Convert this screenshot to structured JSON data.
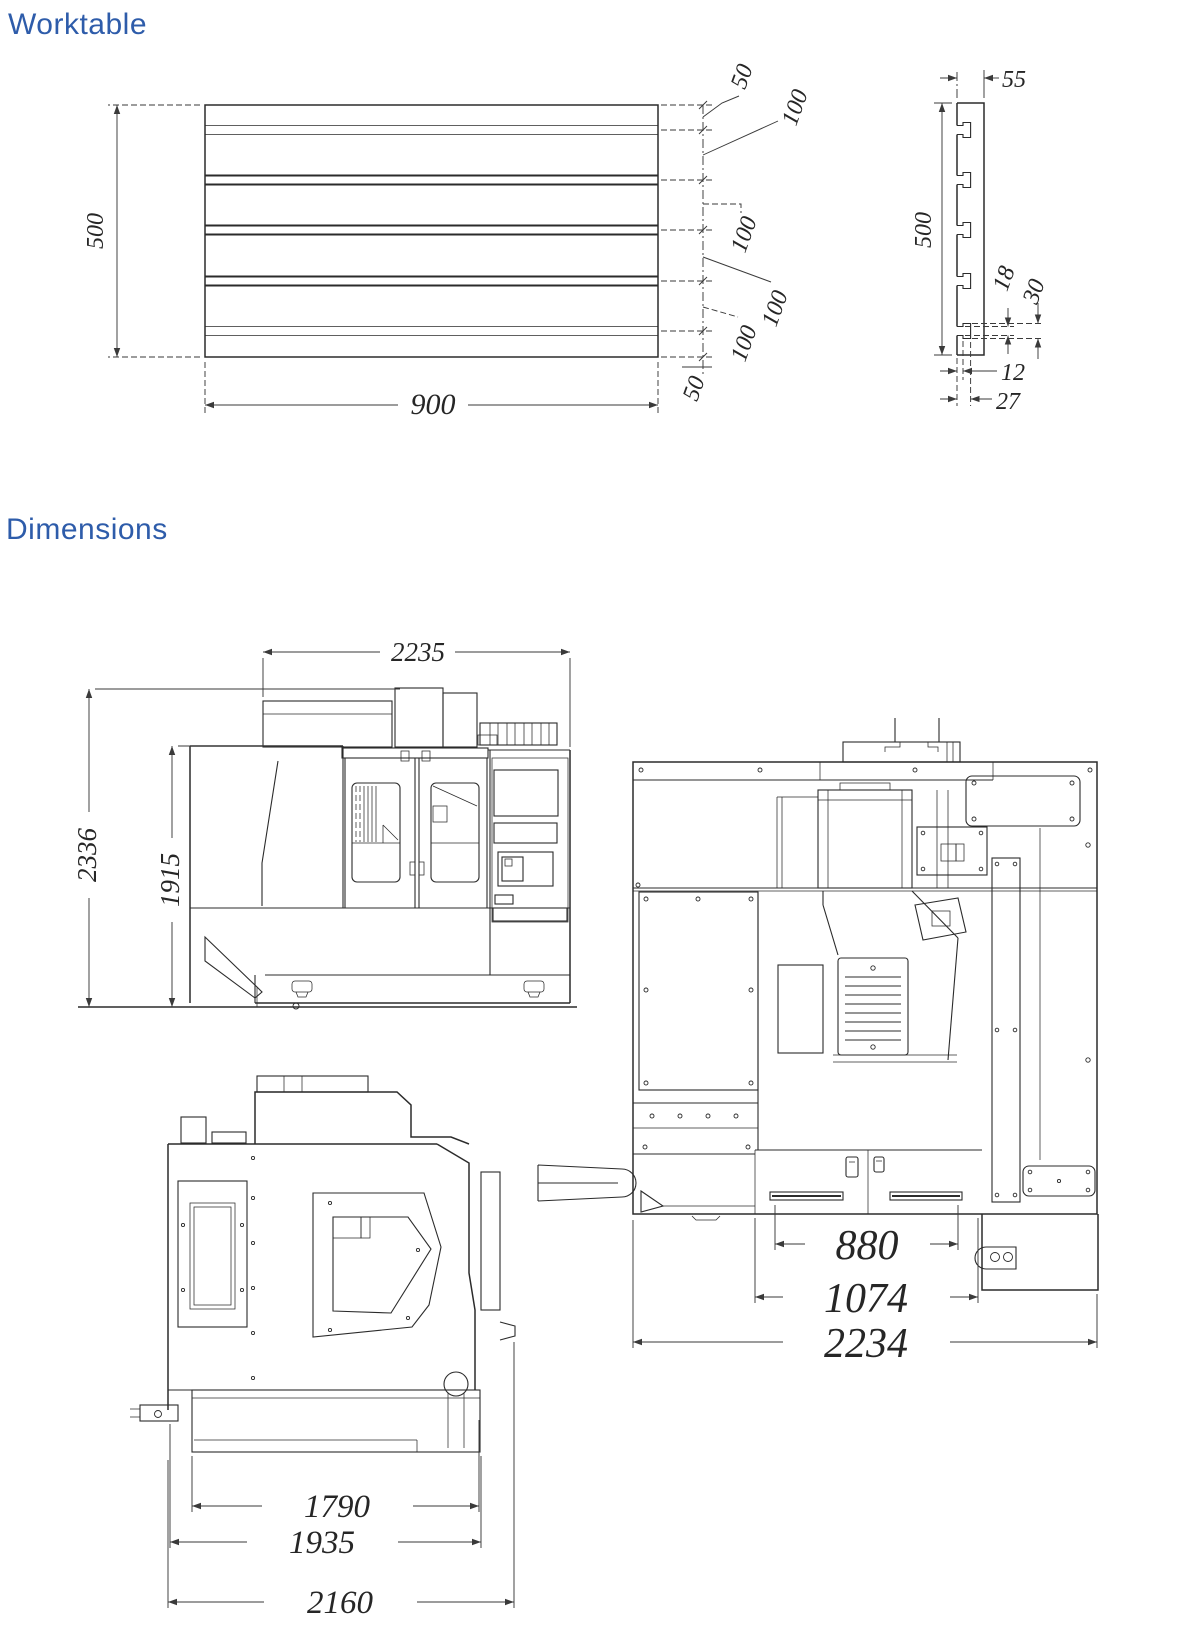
{
  "page": {
    "worktable_title": "Worktable",
    "dimensions_title": "Dimensions"
  },
  "colors": {
    "accent_blue": "#2e5caa",
    "line_color": "#2b2b2b"
  },
  "worktable_top_view": {
    "length": "900",
    "width": "500",
    "right_chain": [
      "50",
      "100",
      "100",
      "100",
      "100",
      "50"
    ]
  },
  "worktable_section_view": {
    "thickness": "55",
    "width": "500",
    "tslot_slot_width": "18",
    "tslot_tee_width": "30",
    "tslot_slot_depth": "12",
    "tslot_total_depth": "27"
  },
  "machine_front_view": {
    "overall_width": "2235",
    "overall_height": "2336",
    "enclosure_height": "1915"
  },
  "machine_side_view": {
    "inner_depth": "1790",
    "mid_depth": "1935",
    "overall_depth": "2160"
  },
  "machine_top_view": {
    "table_width": "880",
    "saddle_width": "1074",
    "overall_width": "2234"
  }
}
